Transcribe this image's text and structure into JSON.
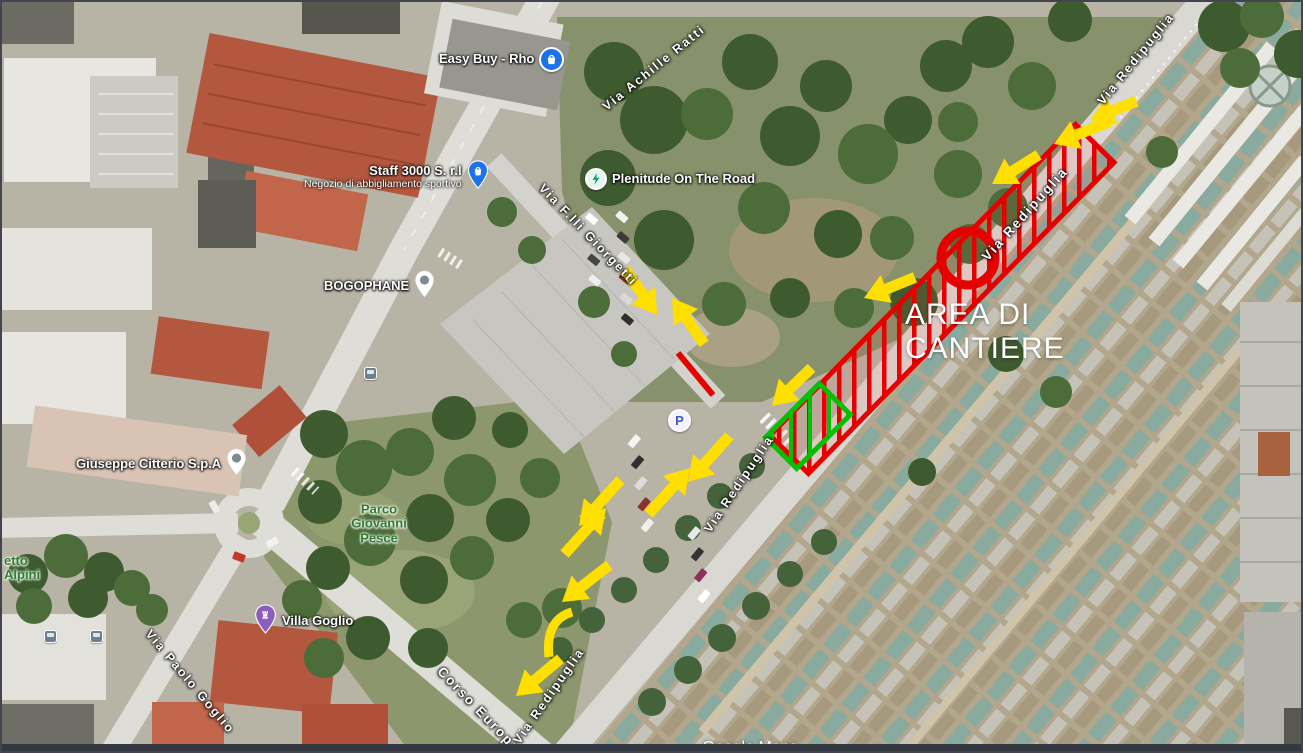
{
  "map": {
    "attribution": "Google Maps",
    "construction_area_label": {
      "line1": "AREA DI",
      "line2": "CANTIERE"
    },
    "parking_icon_label": "P",
    "pois": [
      {
        "name": "Easy Buy - Rho",
        "icon": "shopping-bag-circle-icon",
        "icon_color": "#1a73e8"
      },
      {
        "name": "Staff 3000 S. r.l",
        "subtitle": "Negozio di abbigliamento sportivo",
        "icon": "shopping-bag-pin-icon",
        "icon_color": "#1a73e8"
      },
      {
        "name": "Plenitude On The Road",
        "icon": "ev-charging-icon",
        "icon_color": "#12a07a"
      },
      {
        "name": "BOGOPHANE",
        "icon": "generic-place-pin-icon",
        "icon_color": "#7e8b91"
      },
      {
        "name": "Giuseppe Citterio S.p.A",
        "icon": "generic-place-pin-icon",
        "icon_color": "#7e8b91"
      },
      {
        "name": "Villa Goglio",
        "icon": "historic-landmark-pin-icon",
        "icon_color": "#8e5bbf"
      }
    ],
    "park_labels": [
      {
        "lines": [
          "Parco",
          "Giovanni",
          "Pesce"
        ]
      },
      {
        "lines": [
          "etto",
          "Alpini"
        ]
      }
    ],
    "street_labels": [
      {
        "name": "Via Achille Ratti"
      },
      {
        "name": "Via F.lli Giorgetti"
      },
      {
        "name": "Via Redipuglia"
      },
      {
        "name": "Via Redipuglia"
      },
      {
        "name": "Via Redipuglia"
      },
      {
        "name": "Via Redipuglia"
      },
      {
        "name": "Via Paolo Goglio"
      },
      {
        "name": "Corso Europa"
      }
    ],
    "annotations": {
      "colors": {
        "arrow": "#ffdf00",
        "construction": "#e60000",
        "gate": "#00c300"
      },
      "construction_strip": {
        "cx": 940,
        "cy": 297,
        "length": 436,
        "width": 54,
        "angle": -45.5
      },
      "no_entry_circle": {
        "cx": 966,
        "cy": 256,
        "r": 27,
        "stroke_width": 9
      },
      "gate_rect": {
        "cx": 806,
        "cy": 424,
        "w": 76,
        "h": 44,
        "angle": -45
      },
      "closed_segment": {
        "x1": 676,
        "y1": 351,
        "x2": 711,
        "y2": 393
      },
      "arrows": [
        {
          "x": 1052,
          "y": 142,
          "angle": 158,
          "len": 60
        },
        {
          "x": 1088,
          "y": 118,
          "angle": 158,
          "len": 50
        },
        {
          "x": 990,
          "y": 182,
          "angle": 148,
          "len": 55
        },
        {
          "x": 862,
          "y": 296,
          "angle": 158,
          "len": 55
        },
        {
          "x": 770,
          "y": 404,
          "angle": 136,
          "len": 55
        },
        {
          "x": 655,
          "y": 313,
          "angle": 55,
          "len": 56
        },
        {
          "x": 670,
          "y": 296,
          "angle": 235,
          "len": 56
        },
        {
          "x": 688,
          "y": 466,
          "angle": 312,
          "len": 62
        },
        {
          "x": 686,
          "y": 480,
          "angle": 132,
          "len": 62
        },
        {
          "x": 604,
          "y": 506,
          "angle": 312,
          "len": 62
        },
        {
          "x": 577,
          "y": 524,
          "angle": 132,
          "len": 62
        },
        {
          "x": 560,
          "y": 600,
          "angle": 142,
          "len": 60
        },
        {
          "x": 514,
          "y": 694,
          "angle": 140,
          "len": 58
        }
      ],
      "curves": [
        {
          "d": "M 570,610 Q 543,618 547,655"
        }
      ]
    }
  }
}
